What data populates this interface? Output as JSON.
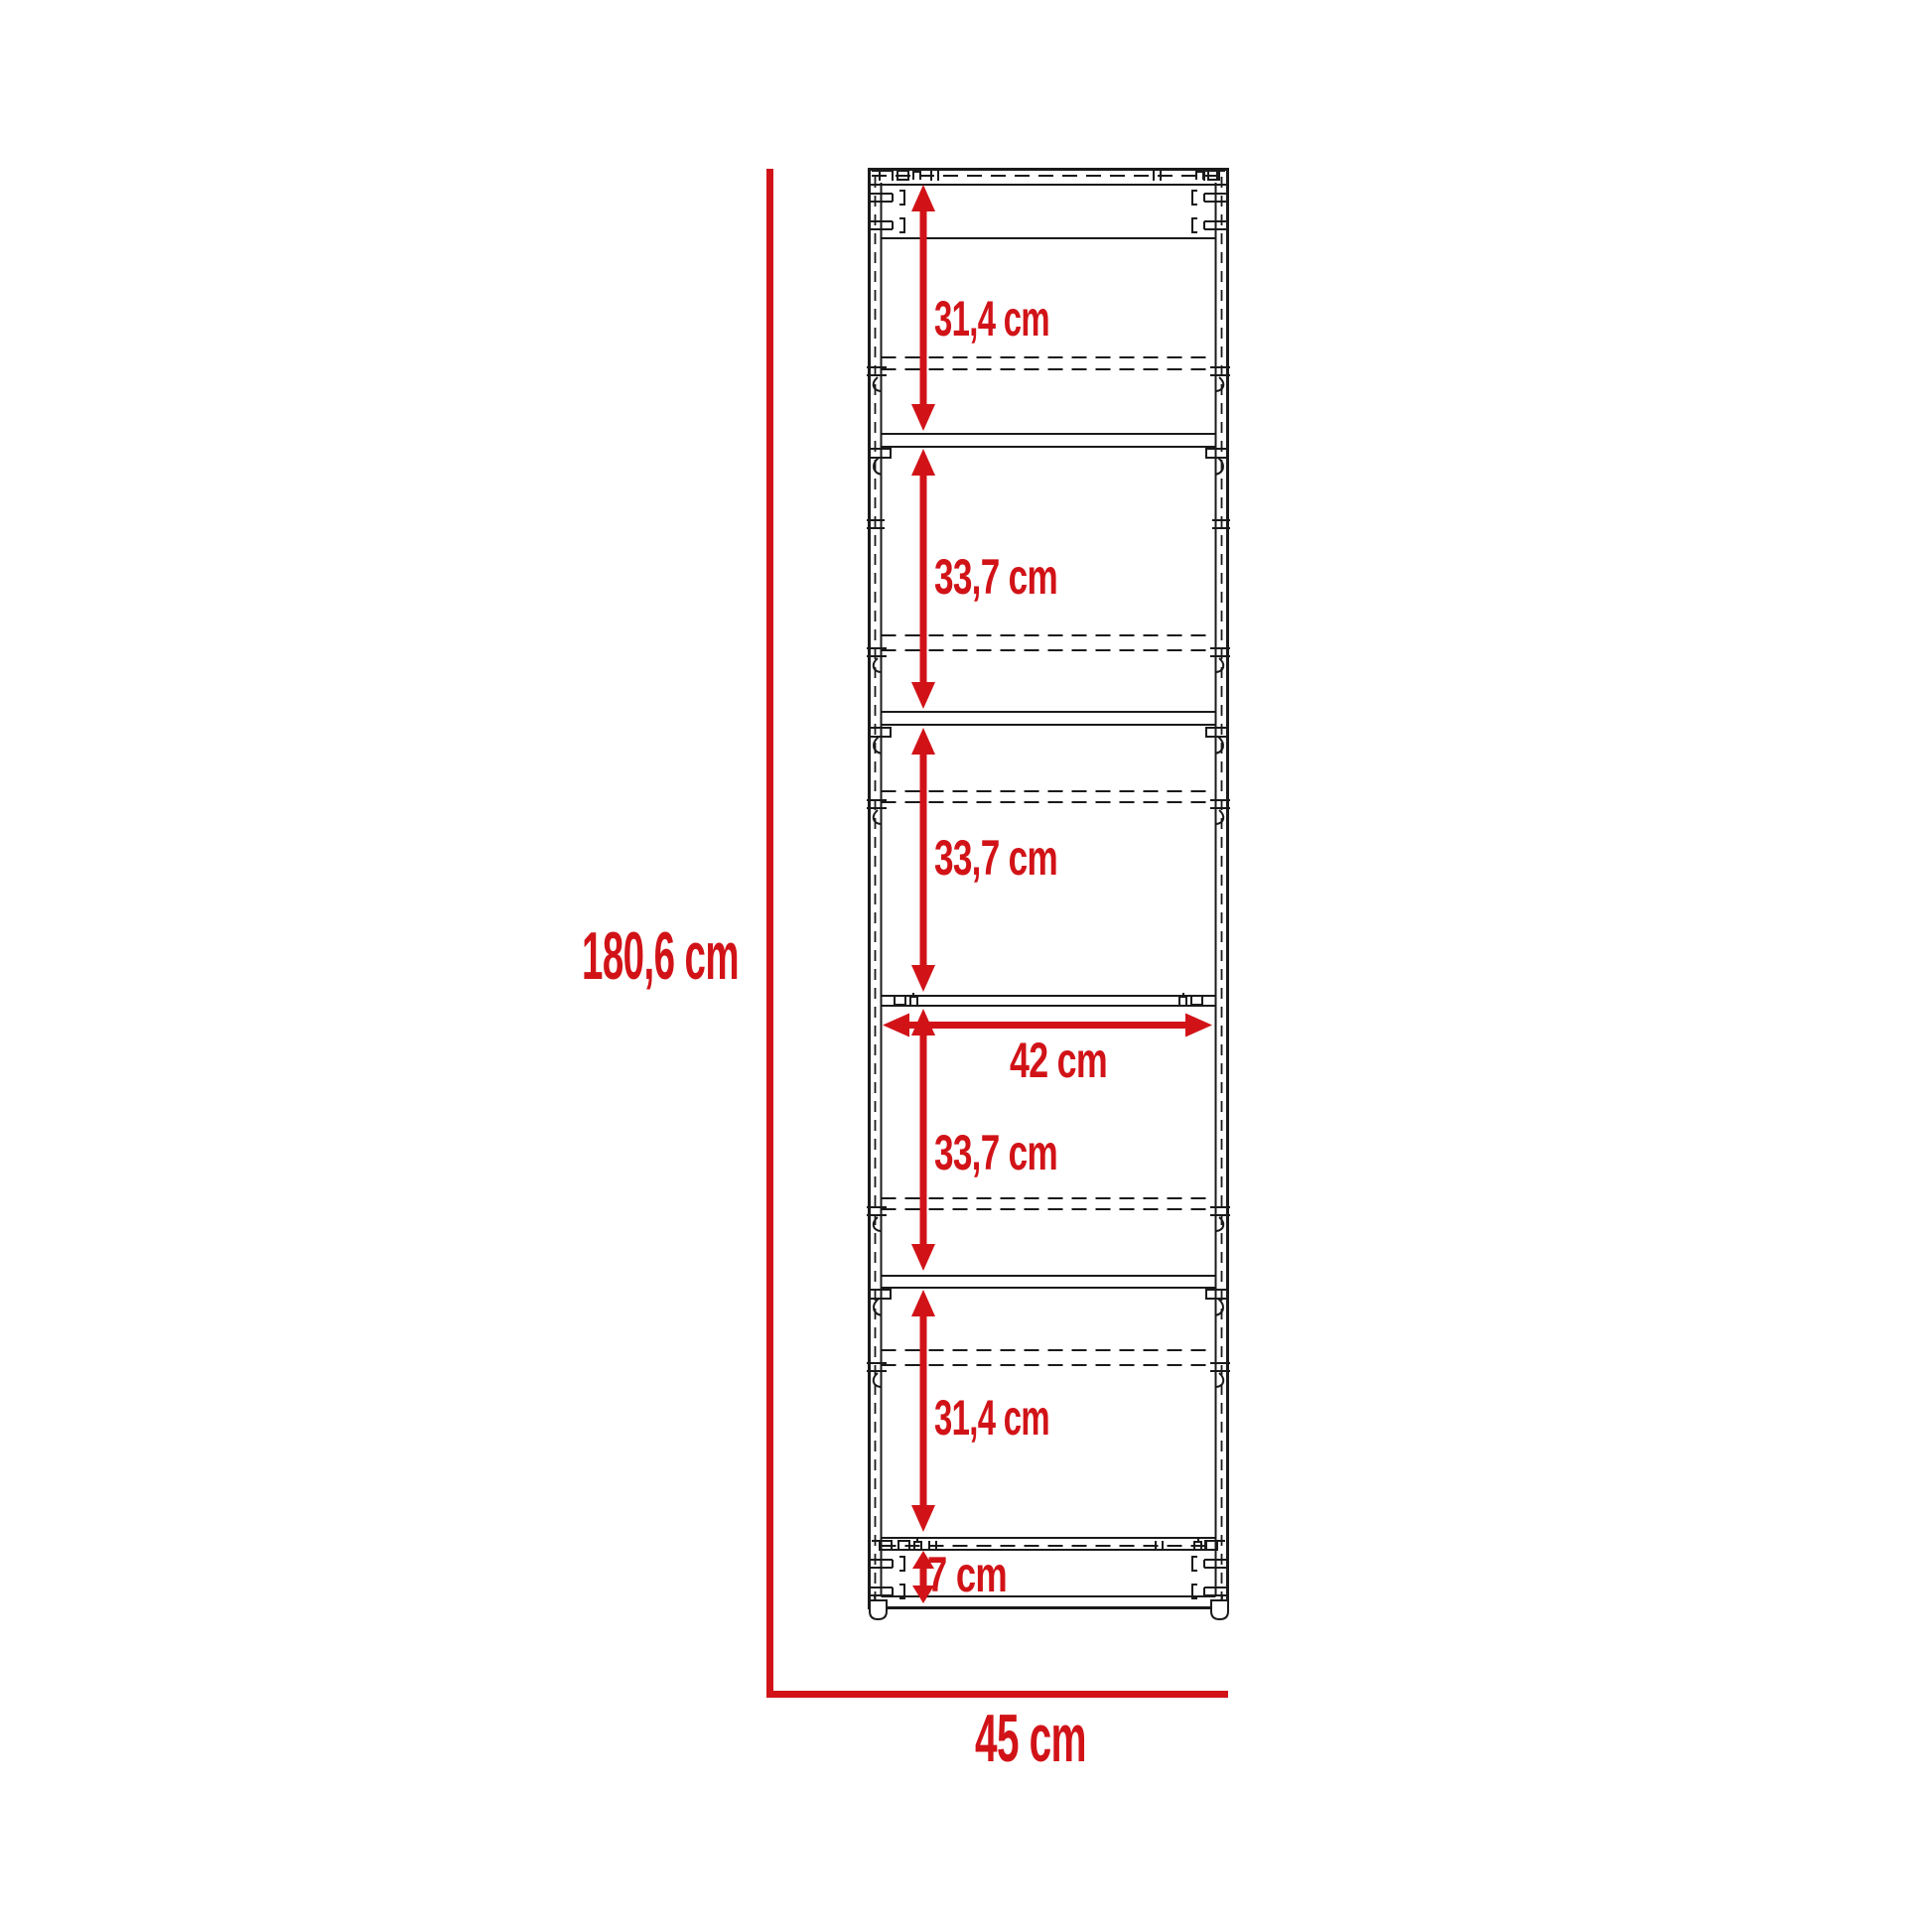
{
  "diagram": {
    "kind": "furniture-dimension-drawing",
    "subject": "tall cabinet front elevation with shelf spacing dimensions",
    "unit": "cm",
    "labels": {
      "overall_height": "180,6 cm",
      "overall_width": "45 cm",
      "interior_width": "42 cm",
      "section_1": "31,4 cm",
      "section_2": "33,7 cm",
      "section_3": "33,7 cm",
      "section_4": "33,7 cm",
      "section_5": "31,4 cm",
      "plinth": "7 cm"
    },
    "values": {
      "overall_height": 180.6,
      "overall_width": 45,
      "interior_width": 42,
      "section_1": 31.4,
      "section_2": 33.7,
      "section_3": 33.7,
      "section_4": 33.7,
      "section_5": 31.4,
      "plinth": 7
    },
    "colors": {
      "dimension": "#d11318",
      "line": "#1a1a1a",
      "background": "#ffffff"
    }
  }
}
